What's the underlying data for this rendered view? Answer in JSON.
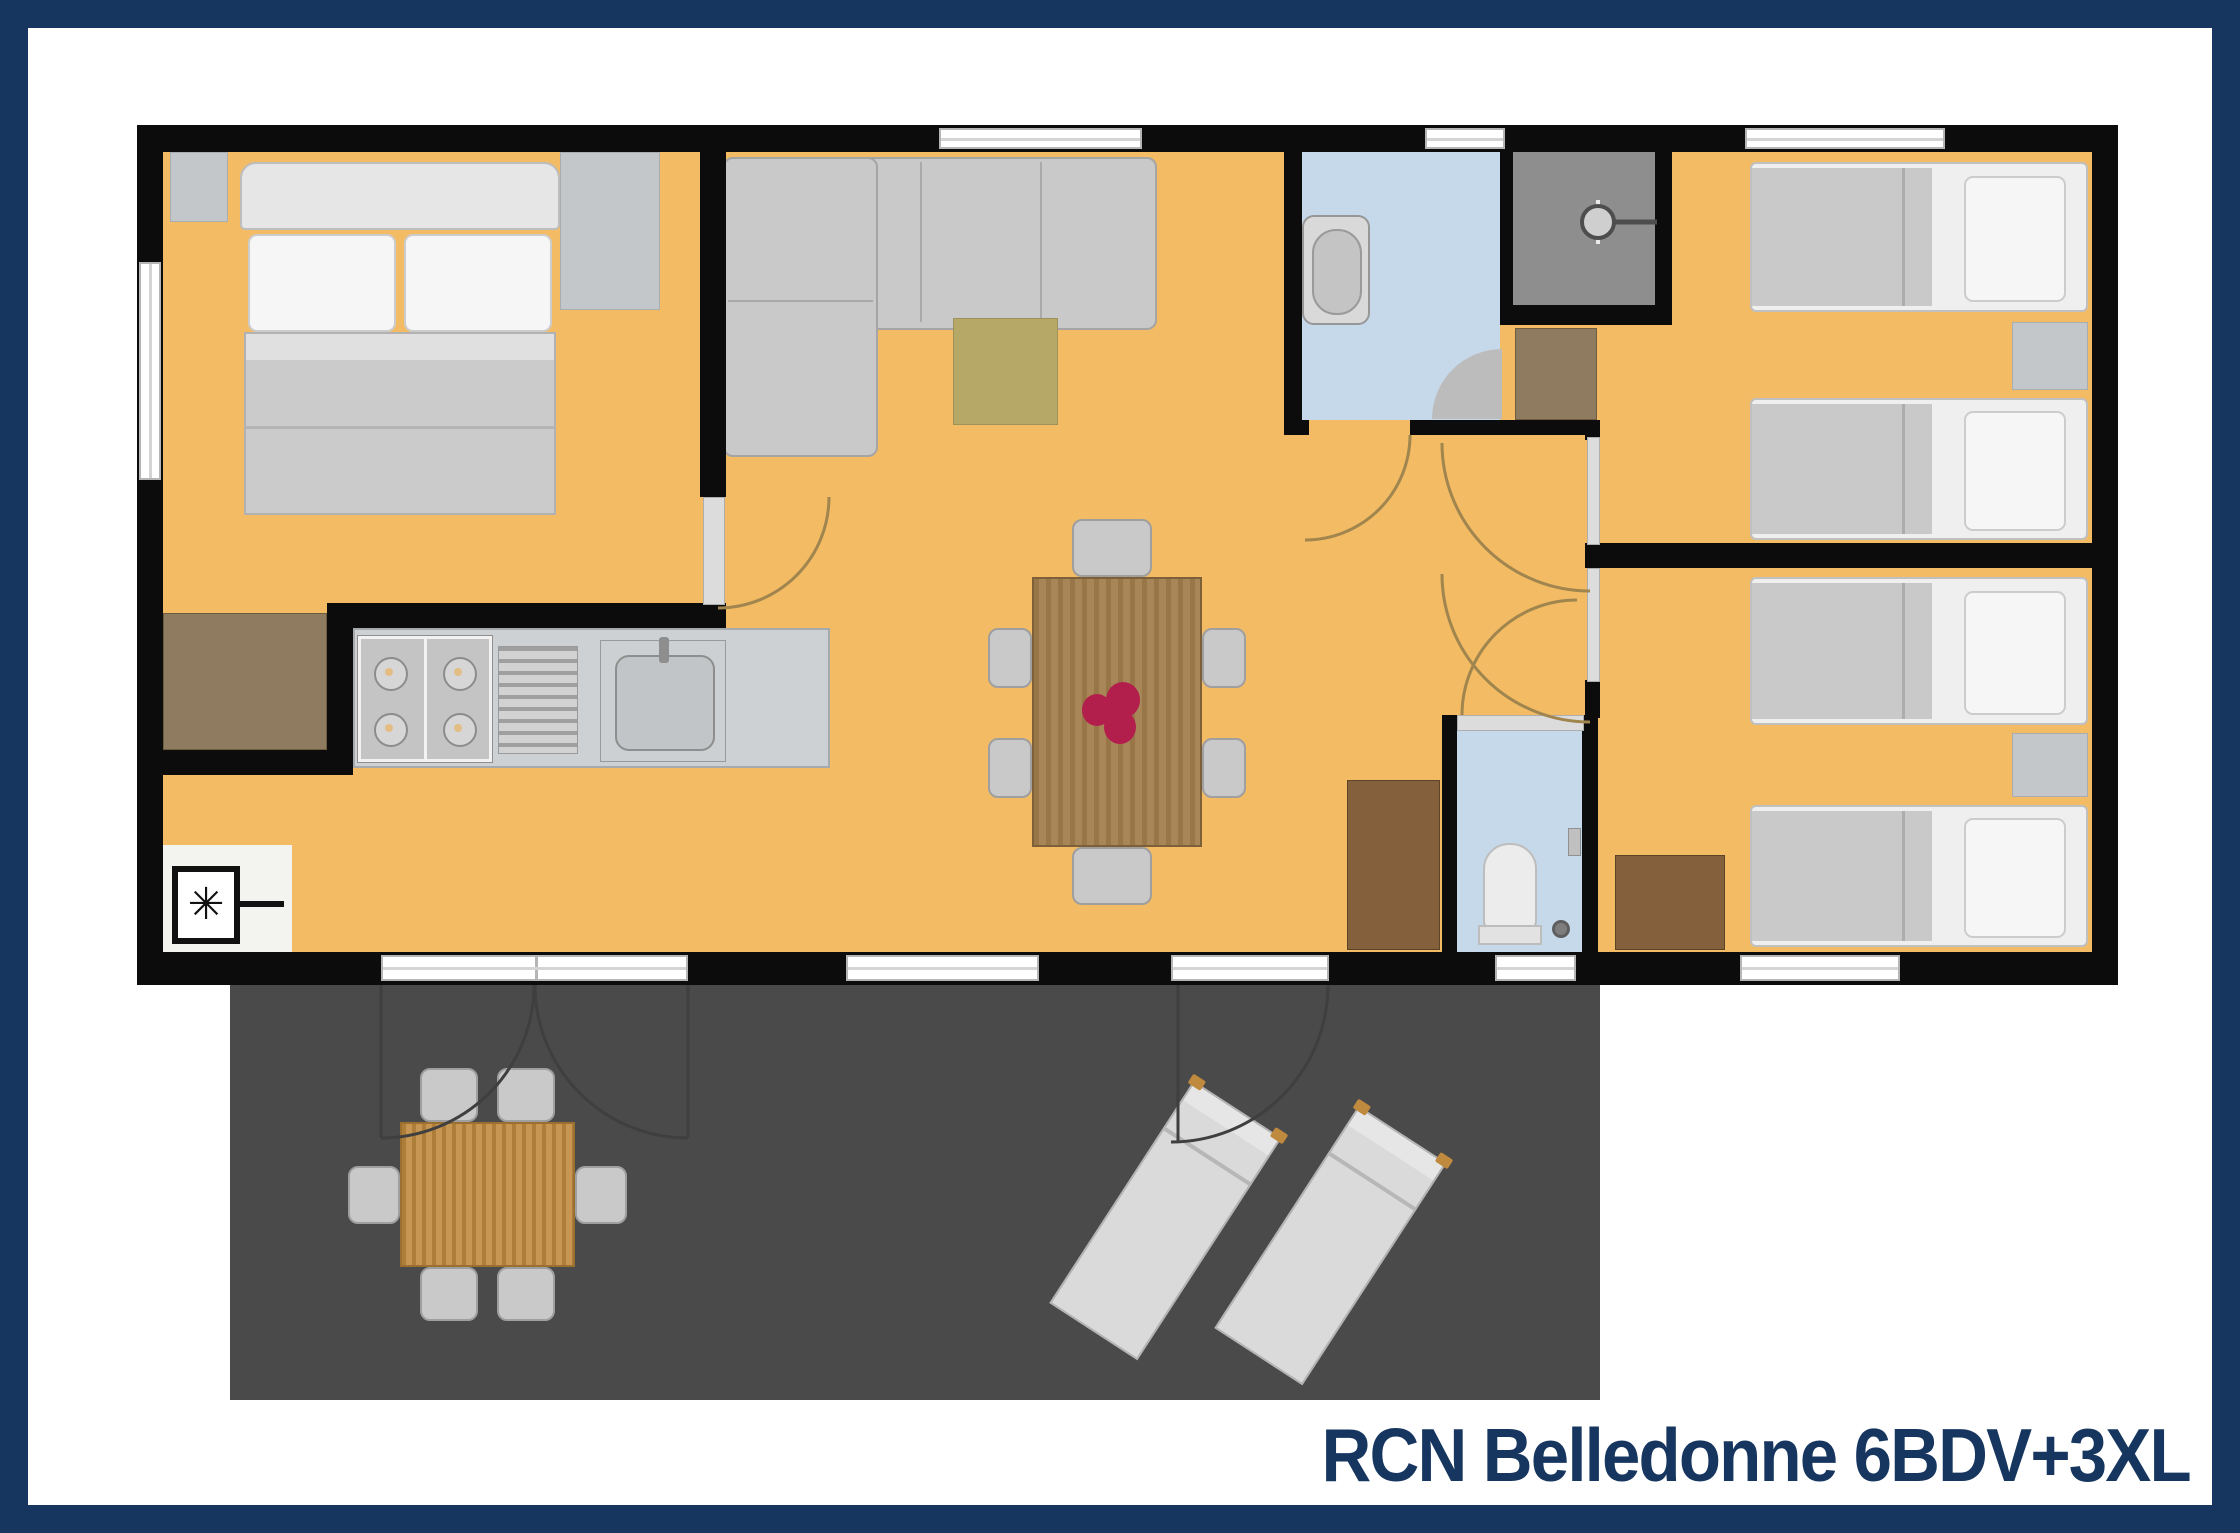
{
  "title": "RCN Belledonne 6BDV+3XL",
  "appliance_symbol": "✳",
  "colors": {
    "navy": "#16365f",
    "title": "#16365f",
    "wall": "#0c0c0c",
    "floor": "#f2bb64",
    "bath_floor": "#c6d9ea",
    "shower_floor": "#8e8e8e",
    "terrace": "#4a4a4a",
    "rug": "#b6a967",
    "sofa": "#c9c9c9",
    "bed_white": "#efefef",
    "blanket": "#c9c9c9",
    "door_panel": "#dcdcdc",
    "arc": "#a0854e",
    "arc_dark": "#3f3f3f",
    "wood_mid": "#8f7c60",
    "wood_dark": "#84603d",
    "wood_table": "#a3804f",
    "wood_terrace_table": "#c28f47",
    "flower": "#b31f4d"
  }
}
